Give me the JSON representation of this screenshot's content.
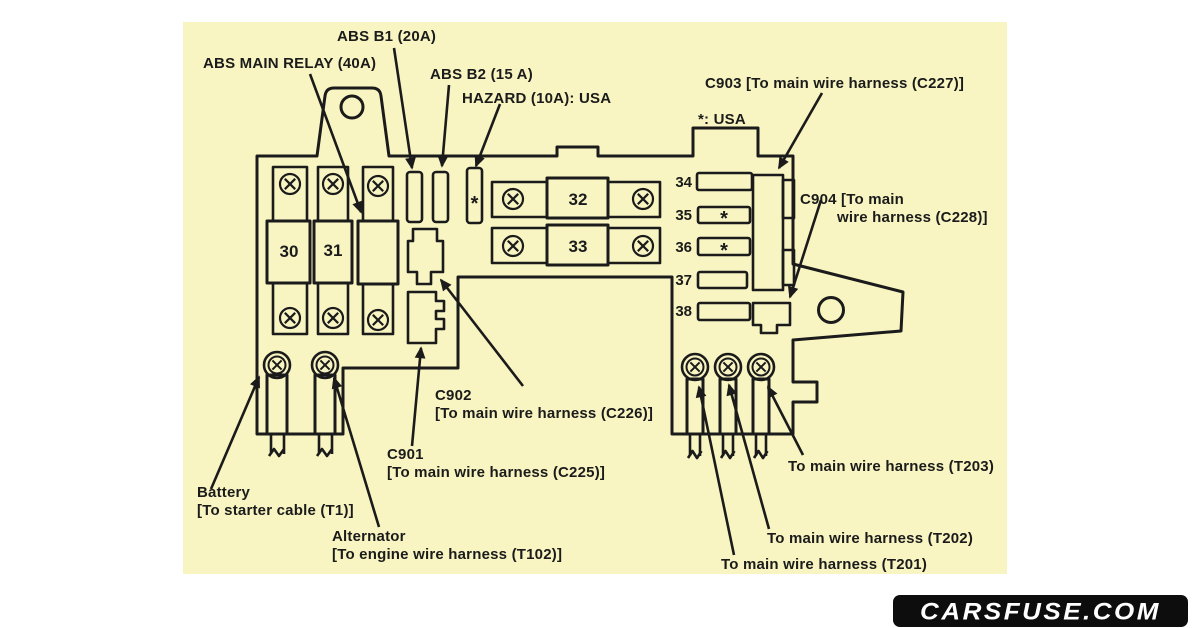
{
  "colors": {
    "page_bg": "#ffffff",
    "panel": "#f8f5c2",
    "ink": "#1b1b1b",
    "watermark_bg": "#0d0d0d",
    "watermark_fg": "#ffffff"
  },
  "watermark": {
    "text": "CARSFUSE.COM"
  },
  "labels": {
    "abs_b1": "ABS B1 (20A)",
    "abs_main_relay": "ABS MAIN RELAY (40A)",
    "abs_b2": "ABS B2 (15 A)",
    "hazard": "HAZARD (10A): USA",
    "c903": "C903 [To main wire harness (C227)]",
    "usa_note": "*: USA",
    "c904_line1": "C904 [To main",
    "c904_line2": "wire harness (C228)]",
    "c902_name": "C902",
    "c902_desc": "[To main wire harness (C226)]",
    "c901_name": "C901",
    "c901_desc": "[To main wire harness (C225)]",
    "battery_name": "Battery",
    "battery_desc": "[To starter cable (T1)]",
    "alternator_name": "Alternator",
    "alternator_desc": "[To engine wire harness (T102)]",
    "t203": "To main wire harness (T203)",
    "t202": "To main wire harness (T202)",
    "t201": "To main wire harness (T201)"
  },
  "fuses": {
    "f30": "30",
    "f31": "31",
    "f32": "32",
    "f33": "33",
    "f34": "34",
    "f35": "35",
    "f36": "36",
    "f37": "37",
    "f38": "38"
  },
  "symbols": {
    "asterisk": "*"
  }
}
